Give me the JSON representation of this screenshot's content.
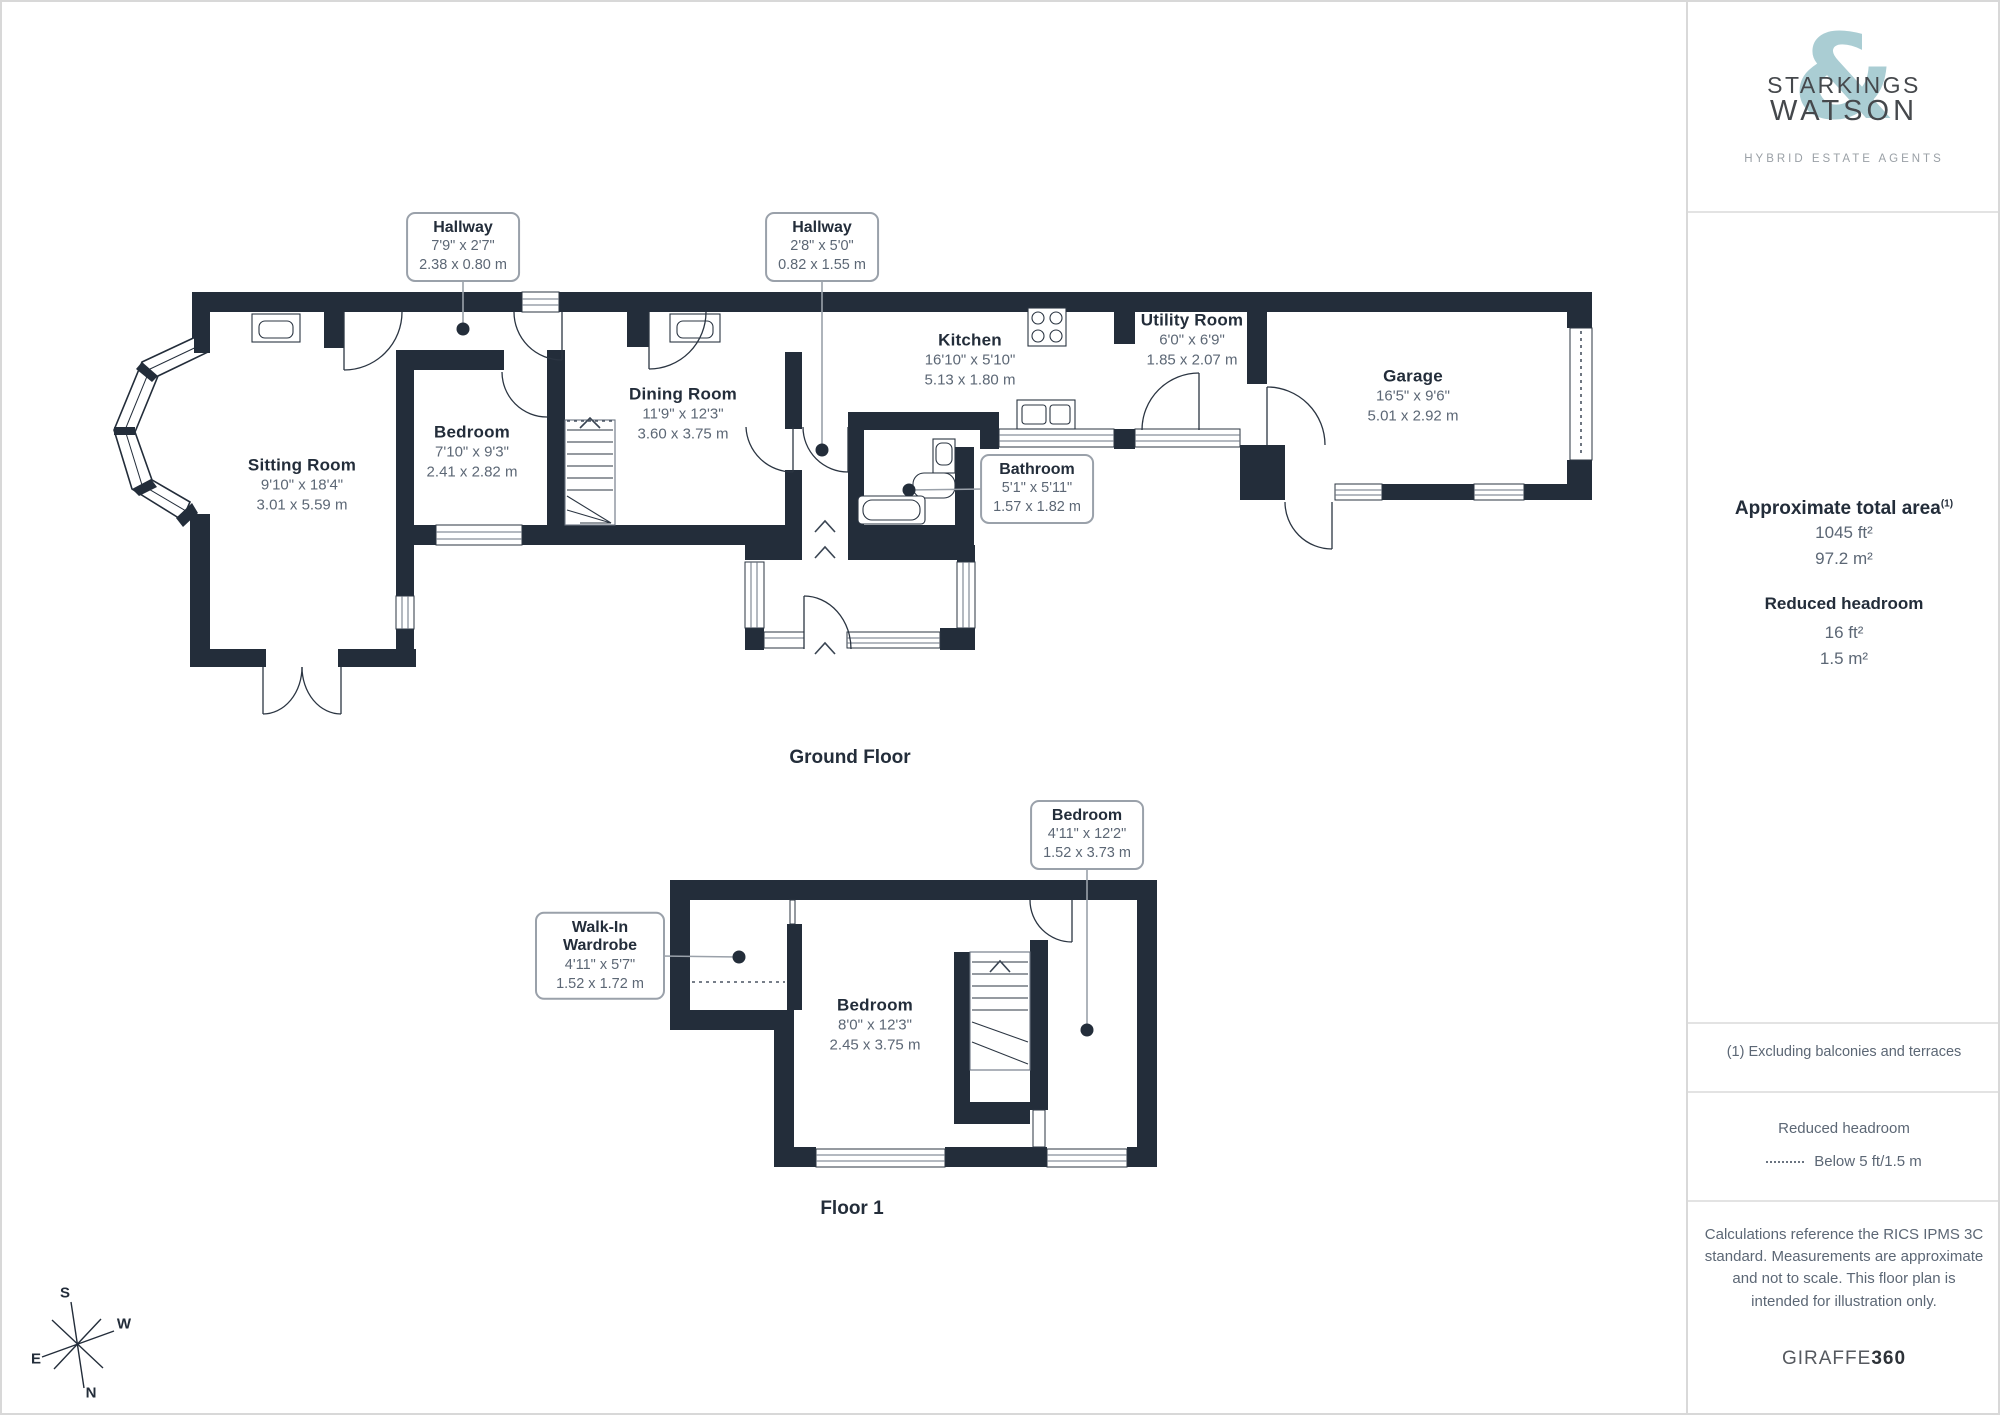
{
  "branding": {
    "line1": "STARKINGS",
    "line2": "WATSON",
    "ampersand": "&",
    "tagline": "HYBRID ESTATE AGENTS"
  },
  "sidebar": {
    "total_area": {
      "title": "Approximate total area",
      "sup": "(1)",
      "imperial": "1045 ft²",
      "metric": "97.2 m²"
    },
    "headroom": {
      "title": "Reduced headroom",
      "imperial": "16 ft²",
      "metric": "1.5 m²"
    },
    "note": "(1) Excluding balconies and terraces",
    "legend": {
      "title": "Reduced headroom",
      "label": "Below 5 ft/1.5 m"
    },
    "disclaimer": "Calculations reference the RICS IPMS 3C standard. Measurements are approximate and not to scale. This floor plan is intended for illustration only.",
    "provider": {
      "name": "GIRAFFE",
      "bold": "360"
    }
  },
  "ground_floor": {
    "title": "Ground Floor",
    "rooms": [
      {
        "name": "Sitting Room",
        "imperial": "9'10\" x 18'4\"",
        "metric": "3.01 x 5.59 m"
      },
      {
        "name": "Bedroom",
        "imperial": "7'10\" x 9'3\"",
        "metric": "2.41 x 2.82 m"
      },
      {
        "name": "Dining Room",
        "imperial": "11'9\" x 12'3\"",
        "metric": "3.60 x 3.75 m"
      },
      {
        "name": "Kitchen",
        "imperial": "16'10\" x 5'10\"",
        "metric": "5.13 x 1.80 m"
      },
      {
        "name": "Utility Room",
        "imperial": "6'0\" x 6'9\"",
        "metric": "1.85 x 2.07 m"
      },
      {
        "name": "Garage",
        "imperial": "16'5\" x 9'6\"",
        "metric": "5.01 x 2.92 m"
      }
    ],
    "callouts": [
      {
        "name": "Hallway",
        "imperial": "7'9\" x 2'7\"",
        "metric": "2.38 x 0.80 m"
      },
      {
        "name": "Hallway",
        "imperial": "2'8\" x 5'0\"",
        "metric": "0.82 x 1.55 m"
      },
      {
        "name": "Bathroom",
        "imperial": "5'1\" x 5'11\"",
        "metric": "1.57 x 1.82 m"
      }
    ]
  },
  "floor1": {
    "title": "Floor 1",
    "rooms": [
      {
        "name": "Bedroom",
        "imperial": "8'0\" x 12'3\"",
        "metric": "2.45 x 3.75 m"
      }
    ],
    "callouts": [
      {
        "name": "Bedroom",
        "imperial": "4'11\" x 12'2\"",
        "metric": "1.52 x 3.73 m"
      },
      {
        "name": "Walk-In Wardrobe",
        "imperial": "4'11\" x 5'7\"",
        "metric": "1.52 x 1.72 m"
      }
    ]
  },
  "compass": {
    "n": "N",
    "s": "S",
    "e": "E",
    "w": "W"
  }
}
